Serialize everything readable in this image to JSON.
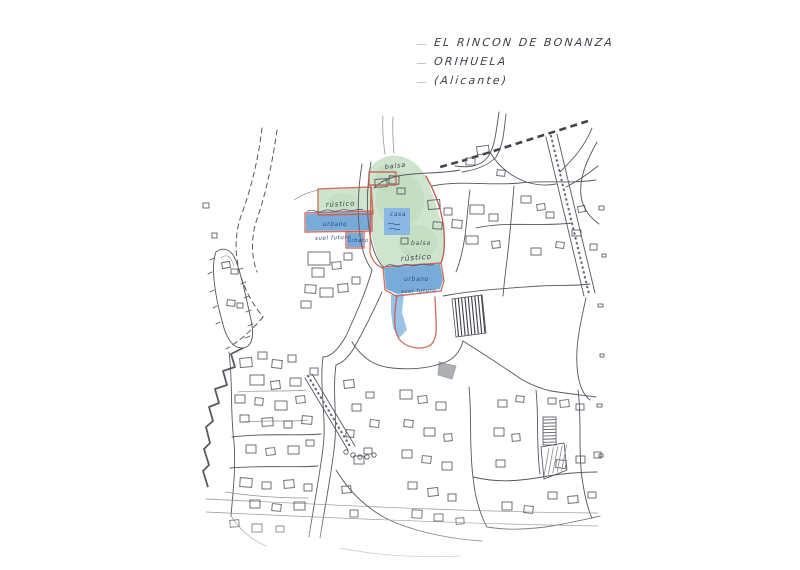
{
  "document": {
    "title_lines": [
      "EL RINCON DE BONANZA",
      "ORIHUELA",
      "(Alicante)"
    ]
  },
  "map": {
    "labels": {
      "balsa_top": "balsa",
      "rustico_upper_left": "rústico",
      "urbano_left_strip": "urbano",
      "suelo_futuro_left": "suel futuro",
      "urbano_small_box": "urbano",
      "casa": "casa",
      "balsa_small": "balsa",
      "rustico_main": "rústico",
      "urbano_lower_strip": "urbano",
      "suelo_futuro_lower": "suel futuro"
    },
    "legend_colors": {
      "rustico_green": "#cfe4cd",
      "urbano_blue": "#79abd9",
      "boundary_red": "#c85a4c",
      "ink_line": "#53565f",
      "handwriting_blue": "#27497e"
    }
  }
}
